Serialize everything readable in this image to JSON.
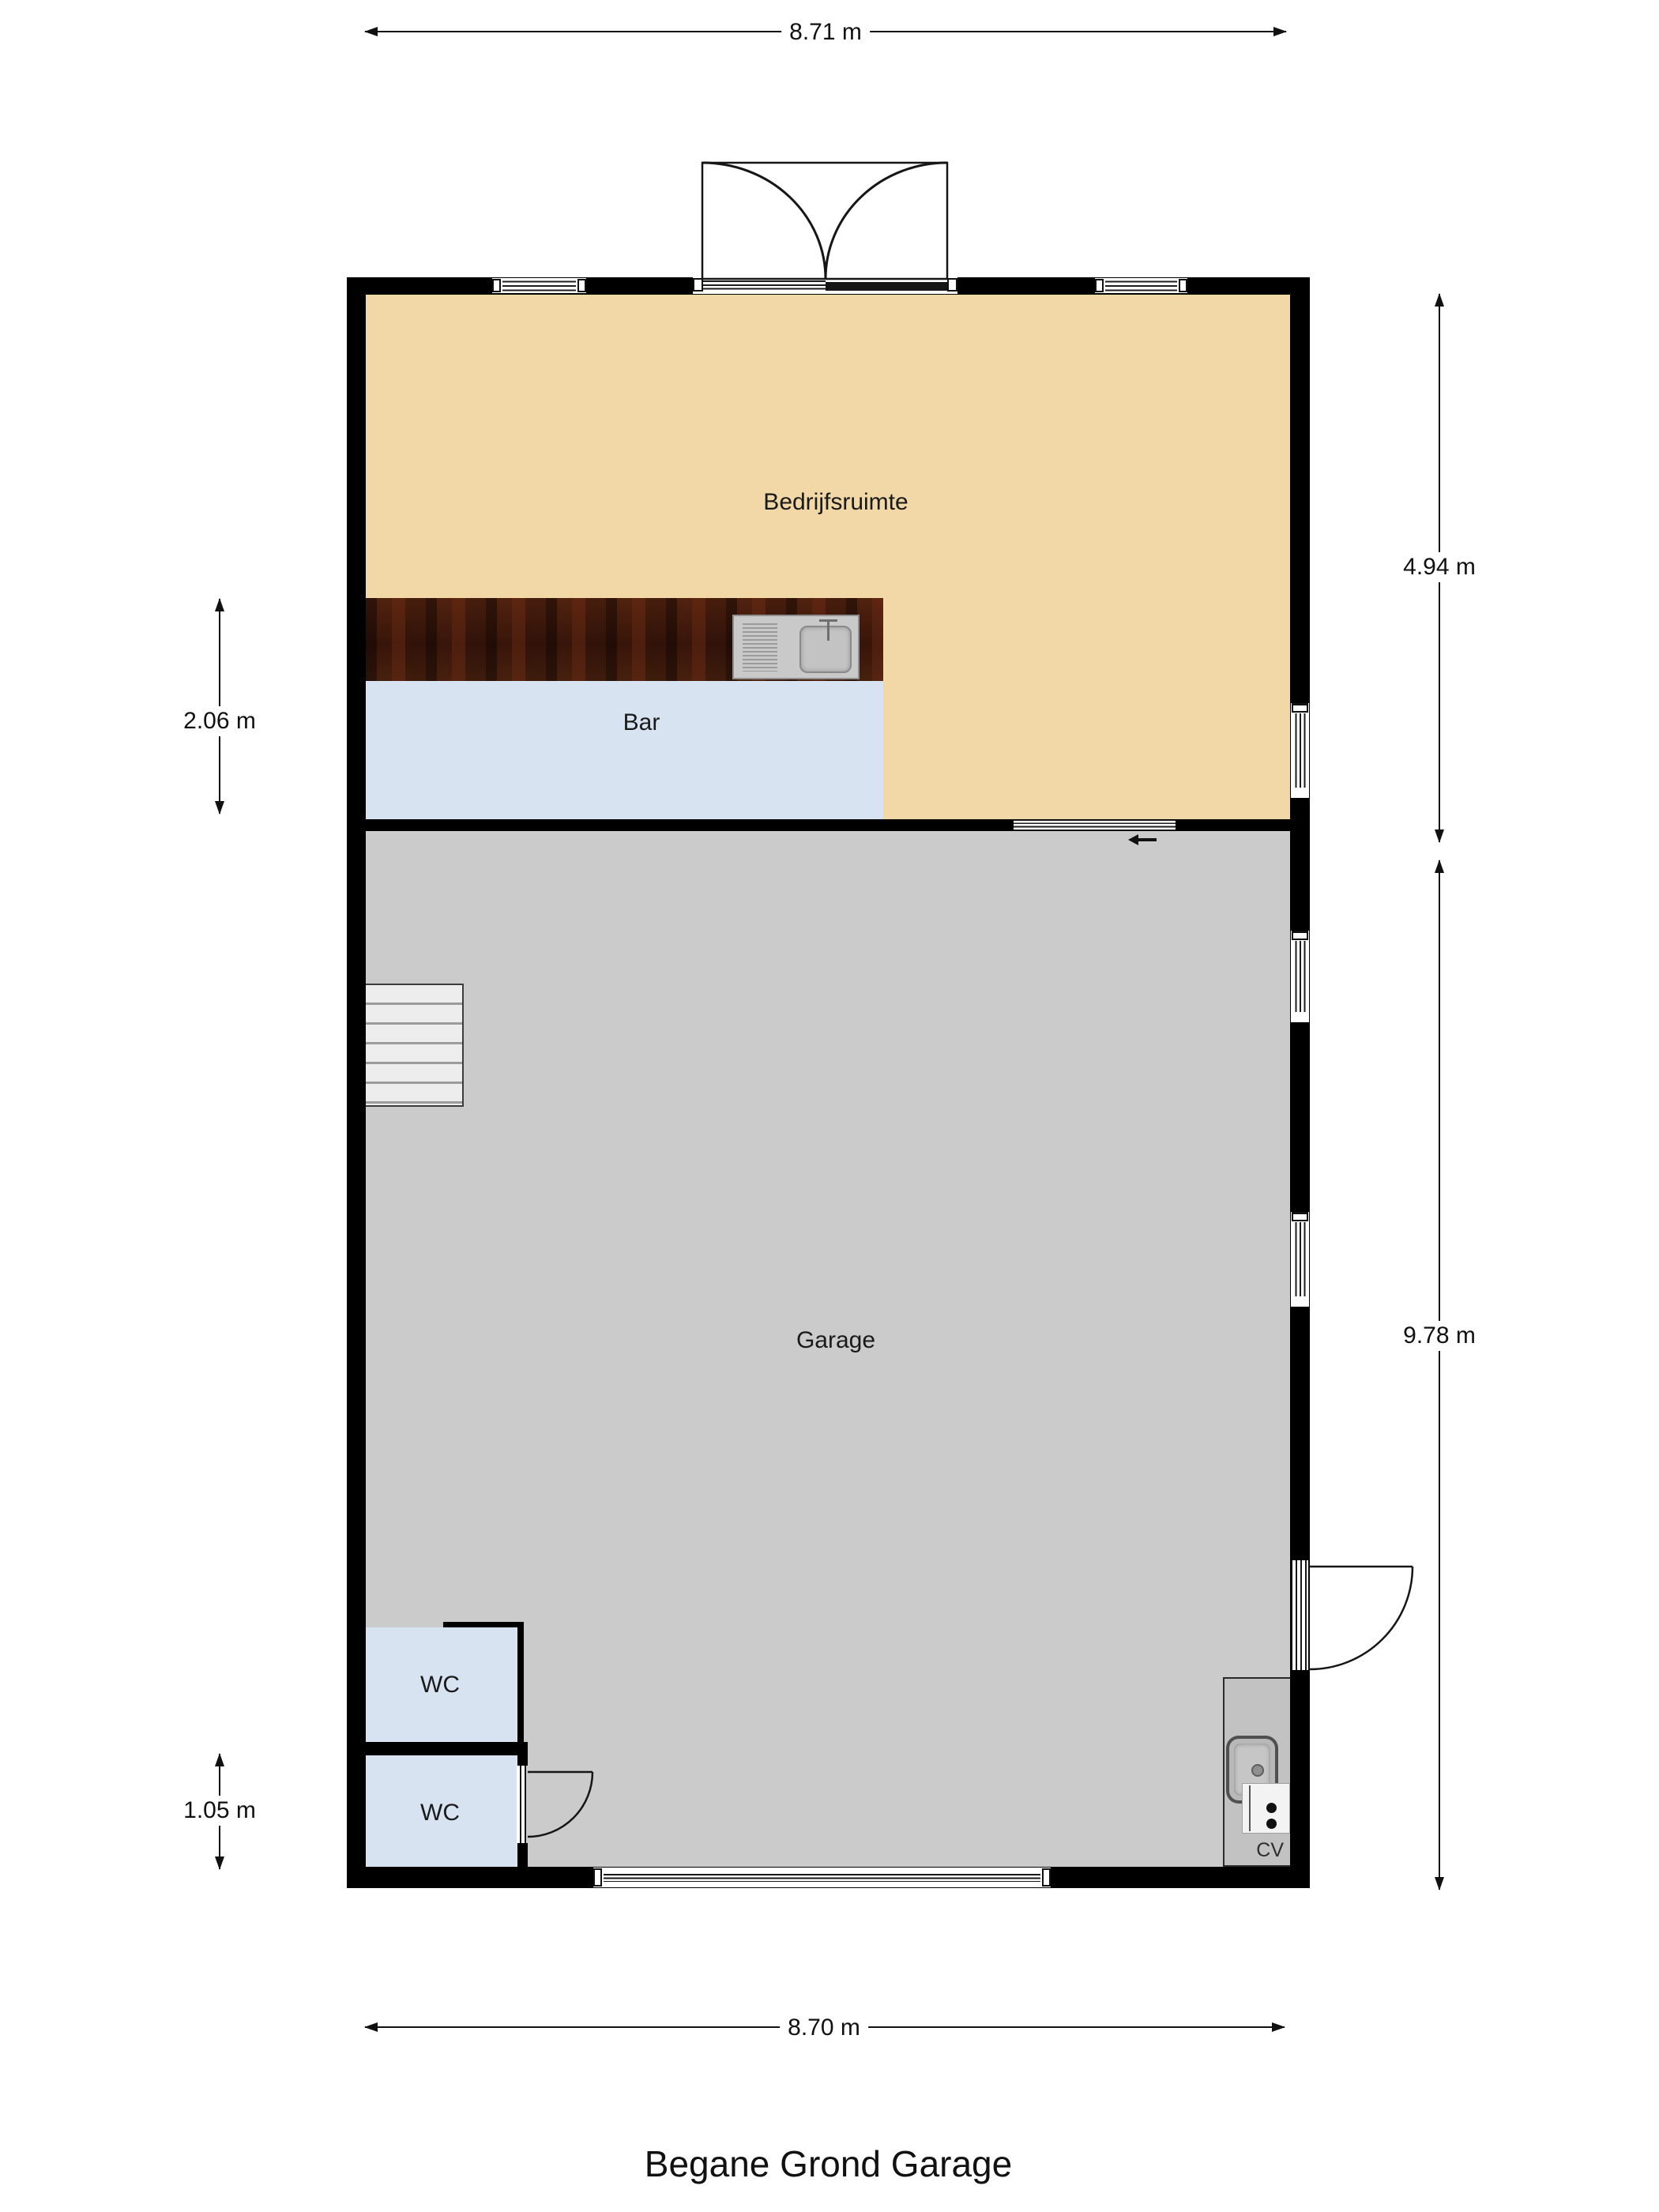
{
  "title": "Begane Grond Garage",
  "rooms": {
    "bedrijfsruimte": {
      "label": "Bedrijfsruimte"
    },
    "bar": {
      "label": "Bar"
    },
    "garage": {
      "label": "Garage"
    },
    "wc1": {
      "label": "WC"
    },
    "wc2": {
      "label": "WC"
    },
    "cv": {
      "label": "CV"
    }
  },
  "dimensions": {
    "top": "8.71 m",
    "bottom": "8.70 m",
    "left_upper": "2.06 m",
    "left_lower": "1.05 m",
    "right_upper": "4.94 m",
    "right_lower": "9.78 m"
  },
  "colors": {
    "wall": "#000000",
    "bedrijfsruimte-floor": "#f2d8a6",
    "bar-floor": "#d7e3f0",
    "wc-floor": "#d7e3f0",
    "garage-floor": "#cbcbcb",
    "cv-floor": "#c2c2c2",
    "counter-wood": "#44200f",
    "stairs-fill": "#ededed",
    "line": "#161616"
  }
}
